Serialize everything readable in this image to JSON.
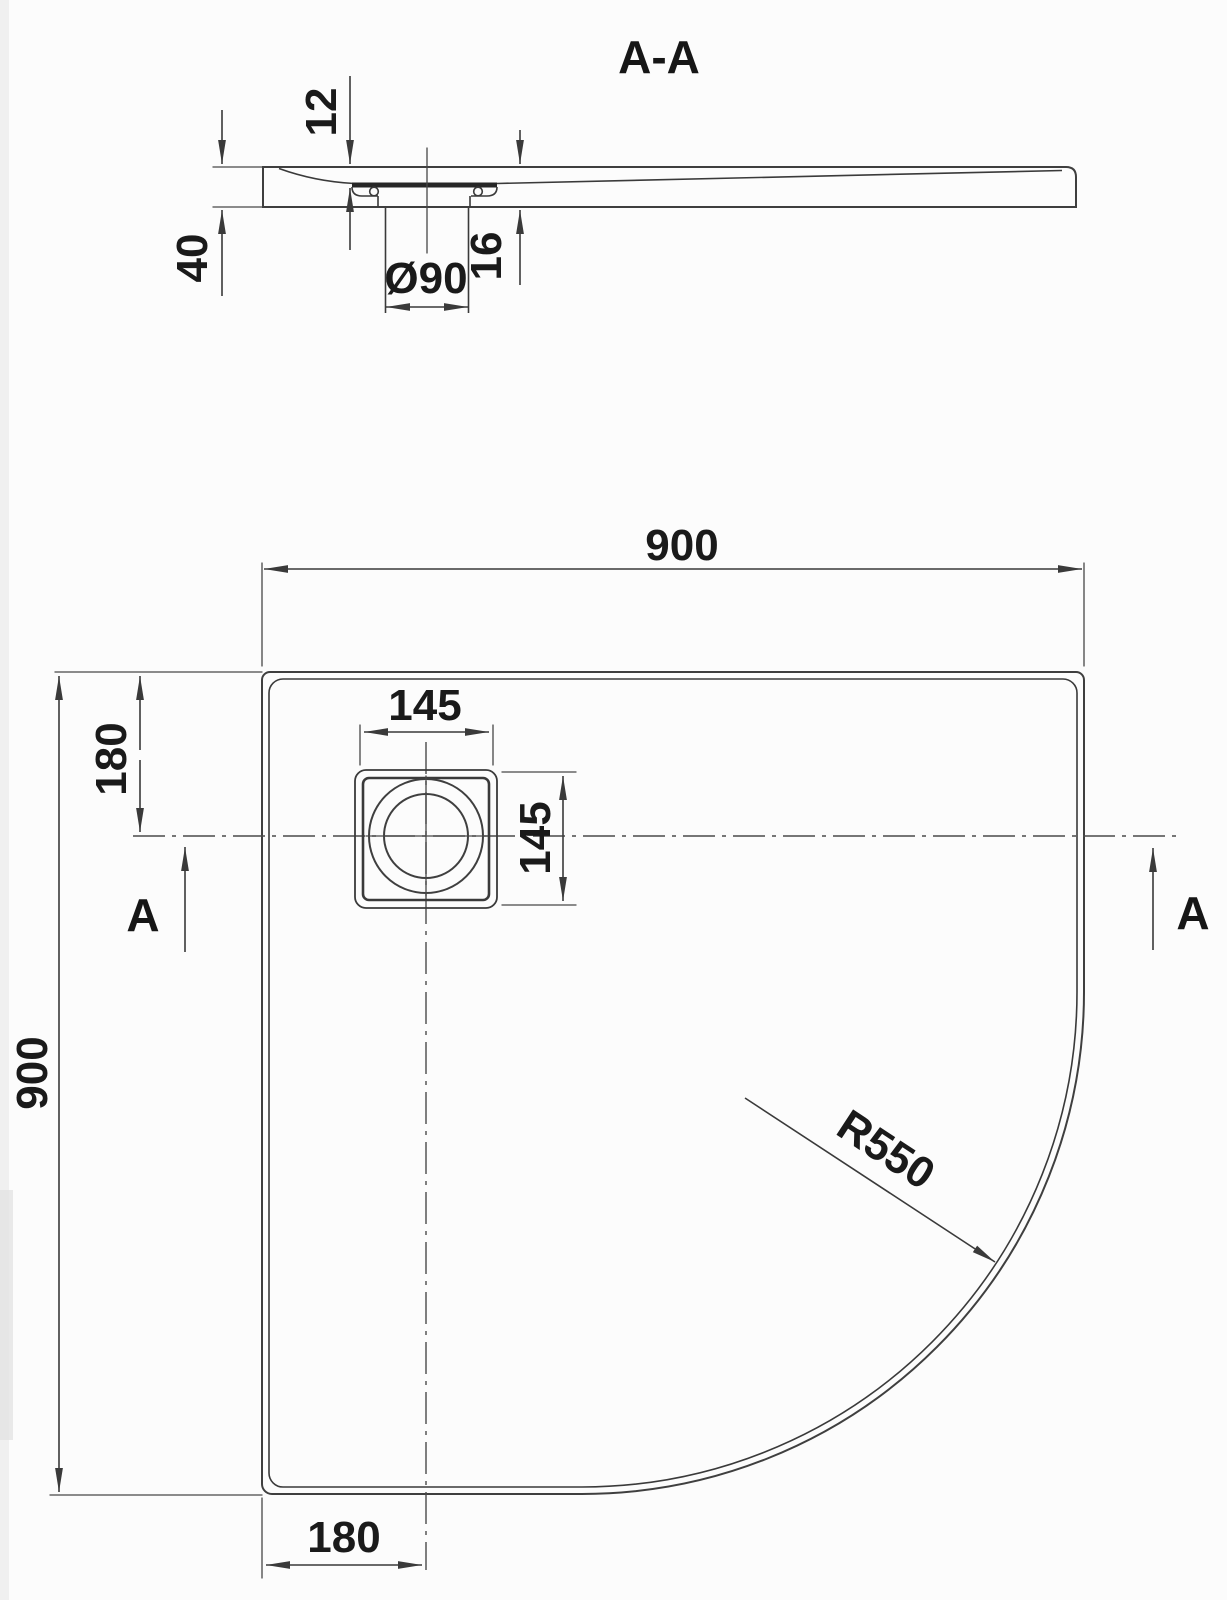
{
  "drawing": {
    "section_view": {
      "title": "A-A",
      "dims": {
        "rim_thickness": "12",
        "total_height": "40",
        "drain_diameter": "Ø90",
        "recess_depth": "16"
      }
    },
    "plan_view": {
      "dims": {
        "width": "900",
        "depth": "900",
        "drain_offset_top": "180",
        "drain_offset_bottom": "180",
        "drain_box_width": "145",
        "drain_box_height": "145",
        "corner_radius": "R550"
      },
      "section_markers": {
        "left": "A",
        "right": "A"
      }
    },
    "colors": {
      "line": "#3f3f3f",
      "accent_dark": "#262626",
      "text": "#1a1a1a",
      "background": "#fcfcfc"
    }
  }
}
